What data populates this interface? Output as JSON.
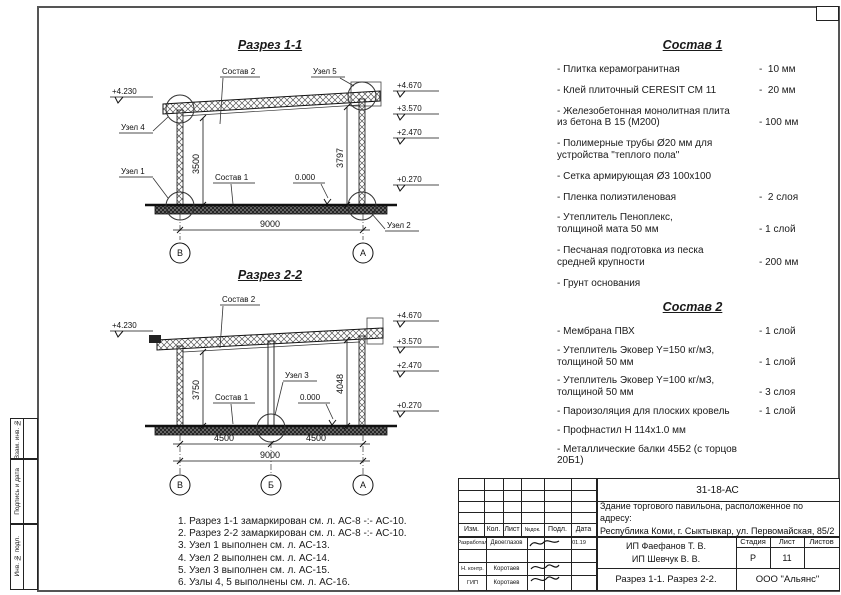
{
  "side_strip": {
    "vzam": "Взам. инв. №",
    "podpis": "Подпись и дата",
    "inv": "Инв. № подл."
  },
  "section1": {
    "title": "Разрез 1-1",
    "labels": {
      "sostav2": "Состав 2",
      "sostav1": "Состав 1",
      "uzel1": "Узел 1",
      "uzel2": "Узел 2",
      "uzel4": "Узел 4",
      "uzel5": "Узел 5",
      "zero": "0.000"
    },
    "elevations": {
      "left": "+4.230",
      "r1": "+4.670",
      "r2": "+3.570",
      "r3": "+2.470",
      "r4": "+0.270"
    },
    "dims": {
      "v_left": "3500",
      "v_right": "3797",
      "width": "9000"
    },
    "axes": {
      "left": "В",
      "right": "А"
    }
  },
  "section2": {
    "title": "Разрез 2-2",
    "labels": {
      "sostav2": "Состав 2",
      "sostav1": "Состав 1",
      "uzel3": "Узел 3",
      "zero": "0.000"
    },
    "elevations": {
      "left": "+4.230",
      "r1": "+4.670",
      "r2": "+3.570",
      "r3": "+2.470",
      "r4": "+0.270"
    },
    "dims": {
      "v_left": "3750",
      "v_right": "4048",
      "w1": "4500",
      "w2": "4500",
      "width": "9000"
    },
    "axes": {
      "left": "В",
      "mid": "Б",
      "right": "А"
    }
  },
  "sostav1": {
    "title": "Состав 1",
    "items": [
      {
        "name": "- Плитка керамогранитная",
        "value": "-  10 мм"
      },
      {
        "name": "- Клей плиточный CERESIT СМ 11",
        "value": "-  20 мм"
      },
      {
        "name": "- Железобетонная  монолитная плита\nиз бетона В 15 (М200)",
        "value": "- 100 мм"
      },
      {
        "name": "- Полимерные трубы Ø20 мм для\nустройства \"теплого пола\"",
        "value": ""
      },
      {
        "name": "- Сетка армирующая Ø3 100х100",
        "value": ""
      },
      {
        "name": "- Пленка полиэтиленовая",
        "value": "-  2 слоя"
      },
      {
        "name": "- Утеплитель Пеноплекс,\nтолщиной мата 50 мм",
        "value": "- 1 слой"
      },
      {
        "name": "- Песчаная подготовка из песка\nсредней крупности",
        "value": "- 200 мм"
      },
      {
        "name": "- Грунт основания",
        "value": ""
      }
    ]
  },
  "sostav2": {
    "title": "Состав 2",
    "items": [
      {
        "name": "- Мембрана ПВХ",
        "value": "- 1 слой"
      },
      {
        "name": "- Утеплитель Эковер Y=150 кг/м3,\nтолщиной 50 мм",
        "value": "- 1 слой"
      },
      {
        "name": "- Утеплитель Эковер Y=100 кг/м3,\nтолщиной 50 мм",
        "value": "- 3 слоя"
      },
      {
        "name": "- Пароизоляция для плоских кровель",
        "value": "- 1 слой"
      },
      {
        "name": "- Профнастил Н 114х1.0 мм",
        "value": ""
      },
      {
        "name": "- Металлические балки 45Б2 (с торцов 20Б1)",
        "value": ""
      }
    ]
  },
  "notes": [
    "1. Разрез 1-1 замаркирован см. л. АС-8 -:- АС-10.",
    "2. Разрез 2-2 замаркирован см. л. АС-8 -:- АС-10.",
    "3. Узел 1 выполнен см. л. АС-13.",
    "4. Узел 2 выполнен см. л. АС-14.",
    "5. Узел 3 выполнен см. л. АС-15.",
    "6. Узлы 4, 5 выполнены см. л. АС-16."
  ],
  "titleblock": {
    "doc_code": "31-18-АС",
    "description": "Здание торгового павильона, расположенное по адресу:\nРеспублика Коми, г. Сыктывкар, ул. Первомайская, 85/2",
    "cols": {
      "izm": "Изм.",
      "kol": "Кол.",
      "list": "Лист",
      "ndok": "№док.",
      "podl": "Подл.",
      "data": "Дата"
    },
    "rows": {
      "razrabotal": "Разработал",
      "razrabotal_name": "Двоеглазов",
      "razrabotal_date": "01.19",
      "nkontr": "Н. контр.",
      "nkontr_name": "Коротаев",
      "gip": "ГИП",
      "gip_name": "Коротаев"
    },
    "clients": "ИП Фаефанов Т. В.\nИП Шевчук В. В.",
    "stage": {
      "label": "Стадия",
      "value": "Р"
    },
    "sheet": {
      "label": "Лист",
      "value": "11"
    },
    "sheets": {
      "label": "Листов",
      "value": ""
    },
    "sheet_title": "Разрез 1-1. Разрез 2-2.",
    "company": "ООО \"Альянс\""
  }
}
